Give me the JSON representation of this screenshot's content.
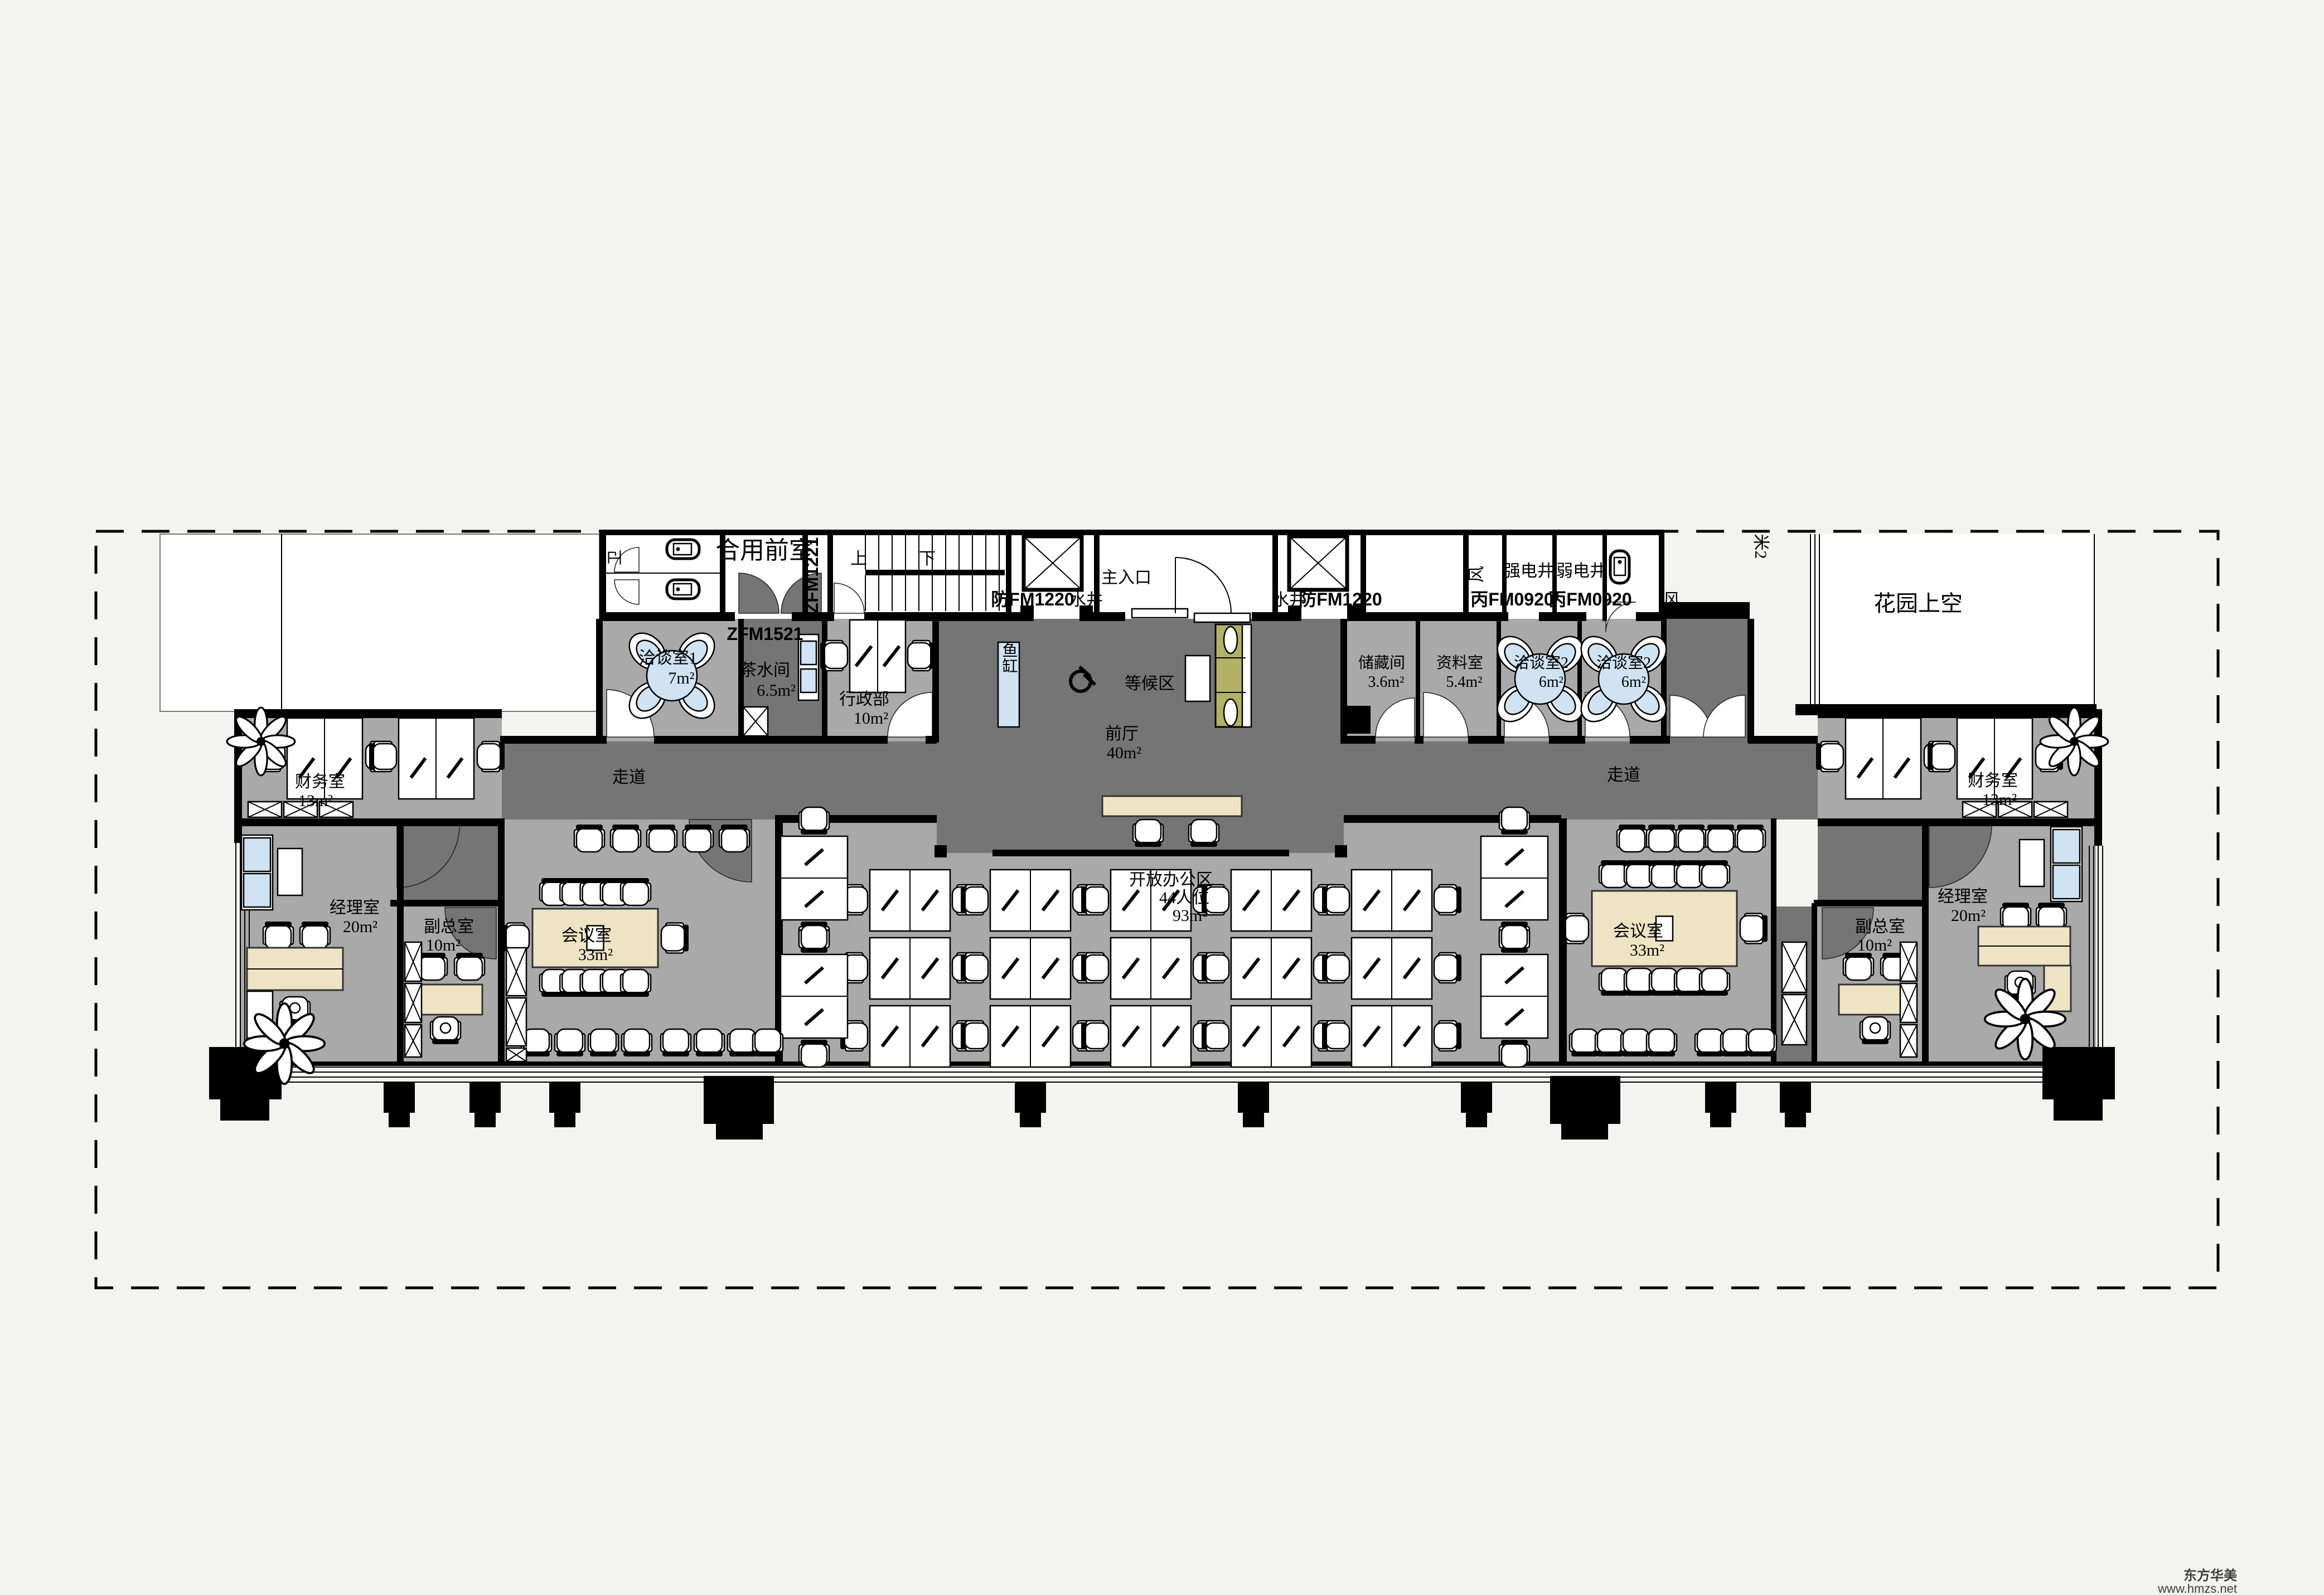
{
  "colors": {
    "background": "#f3f3f1",
    "corridor": "#757575",
    "room_floor": "#a9a9a9",
    "wall": "#000000",
    "table_beige": "#eee4c4",
    "sofa_olive": "#b3b164",
    "accent_blue": "#cfe3f2",
    "paper": "#ffffff"
  },
  "watermark": {
    "brand": "东方华美",
    "site": "www.hmzs.net"
  },
  "doors": {
    "zfm1221": "ZFM1221",
    "zfm1521": "ZFM1521",
    "fm0920_a": "丙FM0920",
    "fm0920_b": "丙FM0920",
    "fm1220_left": "防FM1220",
    "fm1220_right": "防FM1220"
  },
  "rooms": {
    "toilet": {
      "name": "卫"
    },
    "shared_front_room": {
      "name": "合用前室"
    },
    "stairs": {
      "up": "上",
      "down": "下"
    },
    "elevator_left": {
      "shaft": "水井"
    },
    "main_entrance": {
      "name": "主入口"
    },
    "elevator_right": {
      "shaft": "水井"
    },
    "vent_left": {
      "name": "风"
    },
    "strong_power_shaft": {
      "name": "强电井"
    },
    "weak_power_shaft": {
      "name": "弱电井"
    },
    "vent_right": {
      "name": "风"
    },
    "axis_note": {
      "name": "米2"
    },
    "garden_void": {
      "name": "花园上空"
    },
    "negotiation_1": {
      "name": "洽谈室1",
      "area": "7m²"
    },
    "pantry": {
      "name": "茶水间",
      "area": "6.5m²"
    },
    "admin_dept": {
      "name": "行政部",
      "area": "10m²"
    },
    "fish_tank": {
      "name": "鱼缸"
    },
    "waiting_area": {
      "name": "等候区"
    },
    "front_hall": {
      "name": "前厅",
      "area": "40m²"
    },
    "storage": {
      "name": "储藏间",
      "area": "3.6m²"
    },
    "archive": {
      "name": "资料室",
      "area": "5.4m²"
    },
    "negotiation_2a": {
      "name": "洽谈室2",
      "area": "6m²"
    },
    "negotiation_2b": {
      "name": "洽谈室2",
      "area": "6m²"
    },
    "corridor_west": {
      "name": "走道"
    },
    "corridor_east": {
      "name": "走道"
    },
    "finance_west": {
      "name": "财务室",
      "area": "13m²"
    },
    "finance_east": {
      "name": "财务室",
      "area": "13m²"
    },
    "manager_west": {
      "name": "经理室",
      "area": "20m²"
    },
    "manager_east": {
      "name": "经理室",
      "area": "20m²"
    },
    "deputy_west": {
      "name": "副总室",
      "area": "10m²"
    },
    "deputy_east": {
      "name": "副总室",
      "area": "10m²"
    },
    "meeting_west": {
      "name": "会议室",
      "area": "33m²"
    },
    "meeting_east": {
      "name": "会议室",
      "area": "33m²"
    },
    "open_office": {
      "name": "开放办公区",
      "seats": "44人位",
      "area": "93m²"
    }
  }
}
